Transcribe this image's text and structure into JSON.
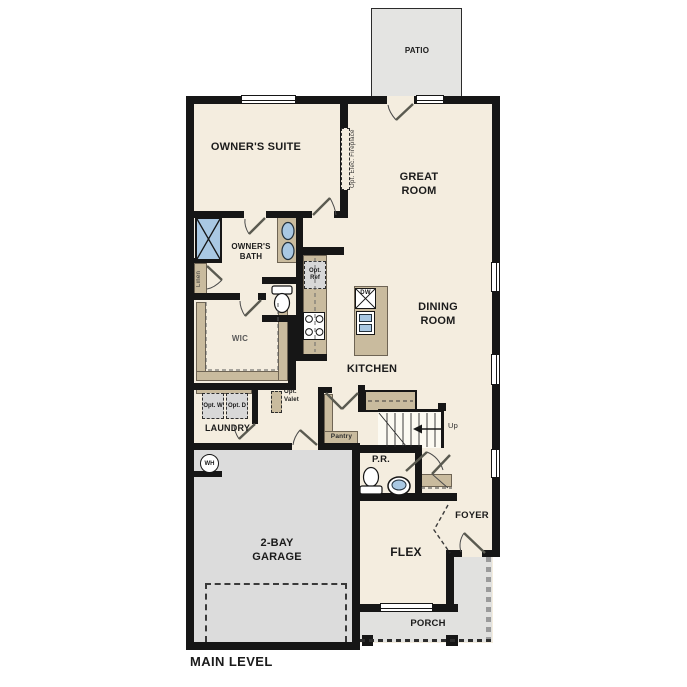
{
  "title": "MAIN LEVEL",
  "rooms": {
    "patio": "PATIO",
    "owners_suite": "OWNER'S SUITE",
    "great_room": "GREAT ROOM",
    "owners_bath": "OWNER'S BATH",
    "wic": "WIC",
    "dining_room": "DINING ROOM",
    "kitchen": "KITCHEN",
    "laundry": "LAUNDRY",
    "pantry": "Pantry",
    "powder_room": "P.R.",
    "foyer": "FOYER",
    "flex": "FLEX",
    "garage": "2-BAY GARAGE",
    "porch": "PORCH"
  },
  "annotations": {
    "fireplace": "Opt. Elec. Fireplace",
    "linen": "Linen",
    "opt_ref": "Opt. Ref",
    "dishwasher": "DW",
    "opt_washer": "Opt. W",
    "opt_dryer": "Opt. D",
    "opt_valet": "Opt. Valet",
    "stairs_up": "Up",
    "water_heater": "WH"
  },
  "colors": {
    "floor": "#f4eddf",
    "wall": "#161616",
    "cabinet": "#c9bb9e",
    "garage": "#dcdcdc",
    "porch": "#e1e1df",
    "patio": "#e4e4e2",
    "fixture_blue": "#a9c8e3",
    "opt_box": "#d8d8d8"
  }
}
